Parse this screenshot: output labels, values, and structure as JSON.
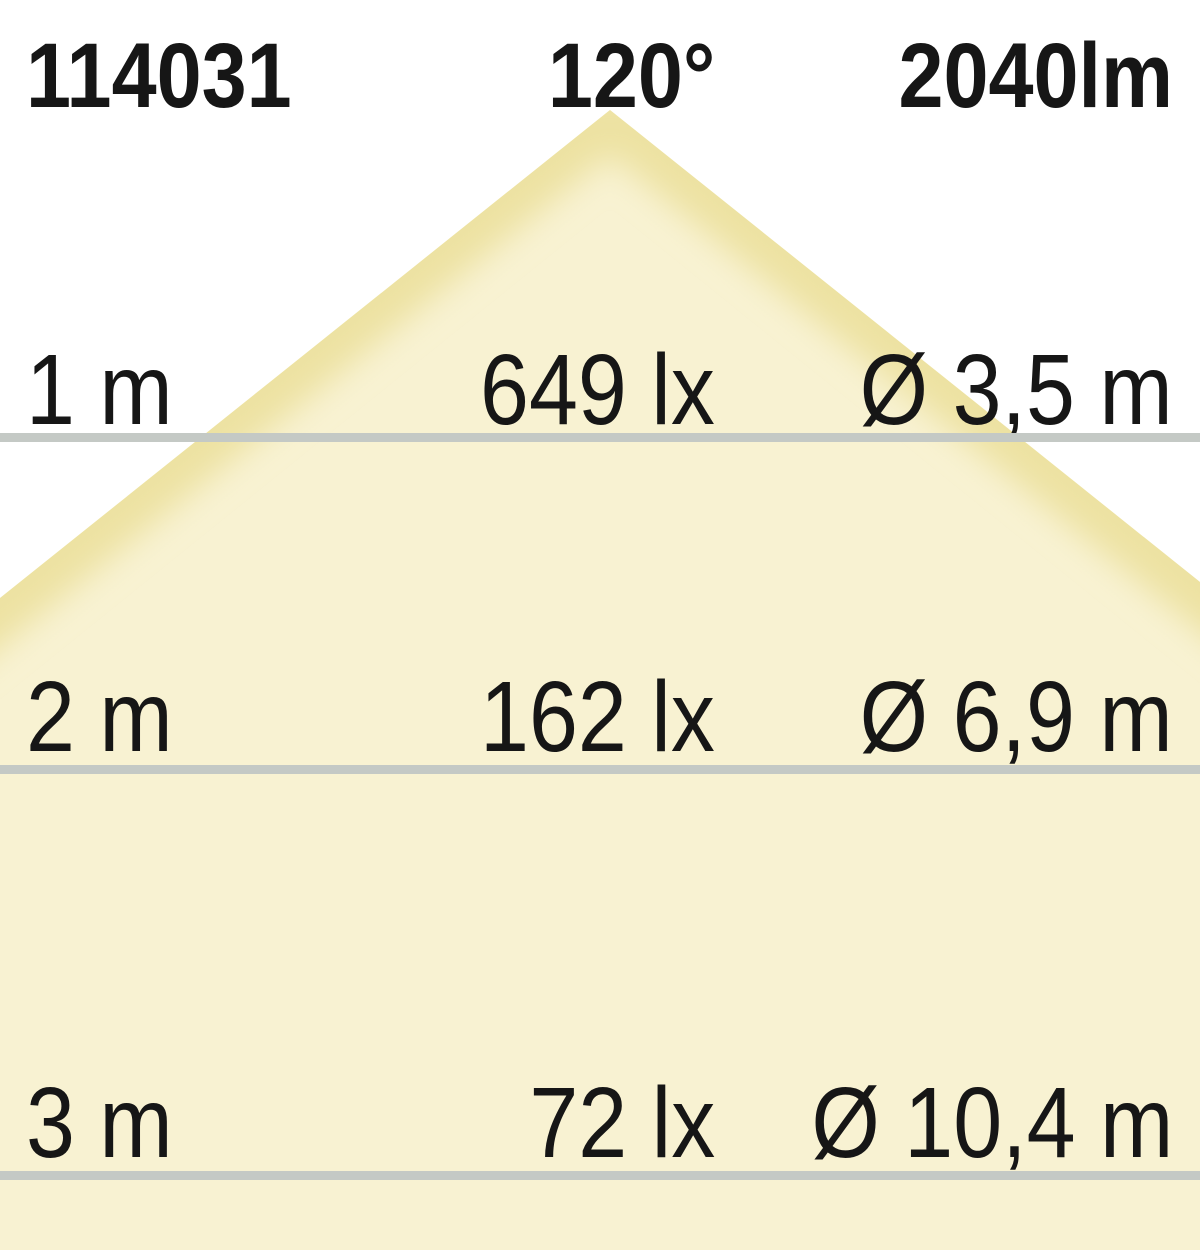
{
  "header": {
    "article_number": "114031",
    "beam_angle": "120°",
    "luminous_flux": "2040lm"
  },
  "rows": [
    {
      "distance": "1 m",
      "illuminance": "649 lx",
      "diameter": "Ø 3,5 m"
    },
    {
      "distance": "2 m",
      "illuminance": "162 lx",
      "diameter": "Ø 6,9 m"
    },
    {
      "distance": "3 m",
      "illuminance": "72 lx",
      "diameter": "Ø 10,4 m"
    }
  ],
  "colors": {
    "cone_fill": "#F8F2D2",
    "cone_edge": "#EDE2A2",
    "divider_line": "#C4C9C5",
    "text": "#161616",
    "background": "#FFFFFF"
  },
  "chart_data": {
    "type": "table",
    "title": "Light cone diagram — article 114031, beam angle 120°, luminous flux 2040lm",
    "categories": [
      "1 m",
      "2 m",
      "3 m"
    ],
    "series": [
      {
        "name": "Illuminance (lx)",
        "values": [
          649,
          162,
          72
        ]
      },
      {
        "name": "Light circle diameter (m)",
        "values": [
          3.5,
          6.9,
          10.4
        ]
      }
    ],
    "legend_position": "none",
    "grid": false
  }
}
